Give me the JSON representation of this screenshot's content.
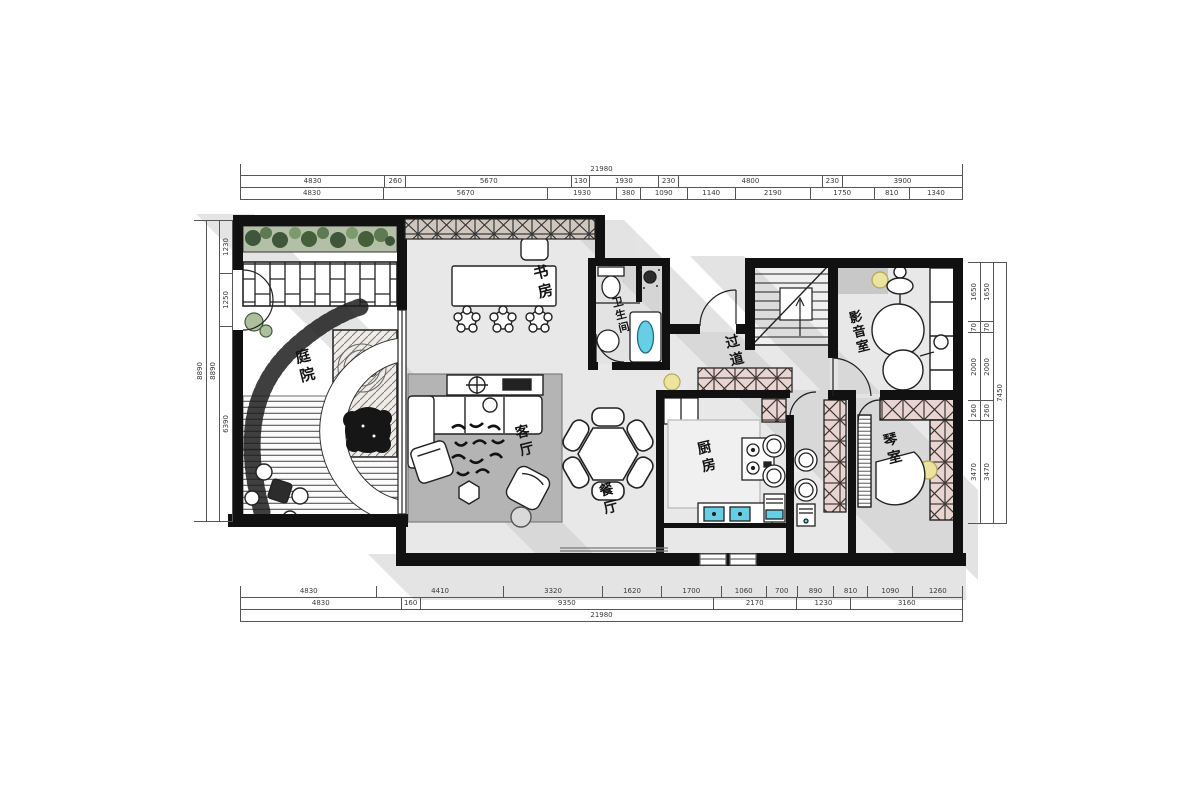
{
  "rooms": {
    "study": "书房",
    "bath": "卫生间",
    "corridor": "过道",
    "media": "影音室",
    "courtyard": "庭院",
    "living": "客厅",
    "dining": "餐厅",
    "kitchen": "厨房",
    "piano": "琴室"
  },
  "dims": {
    "top": {
      "total": "21980",
      "row1": [
        "4830",
        "260",
        "5670",
        "130",
        "1930",
        "230",
        "4800",
        "230",
        "3900"
      ],
      "row2": [
        "4830",
        "5670",
        "1930",
        "380",
        "1090",
        "1140",
        "2190",
        "1750",
        "810",
        "1340"
      ]
    },
    "bottom": {
      "row1": [
        "4830",
        "4410",
        "3320",
        "1620",
        "1700",
        "1060",
        "700",
        "890",
        "810",
        "1090",
        "1260"
      ],
      "row2": [
        "4830",
        "160",
        "9350",
        "2170",
        "1230",
        "3160"
      ],
      "total": "21980"
    },
    "left": {
      "totals": [
        "8890",
        "8890"
      ],
      "segments": [
        "1230",
        "1250",
        "6390"
      ]
    },
    "right": {
      "segments": [
        "1650",
        "70",
        "2000",
        "260",
        "3470"
      ],
      "total": "7450"
    }
  },
  "colors": {
    "wall": "#111111",
    "floor": "#e8e8e8",
    "rug": "#b4b4b4",
    "shadow": "#c9c9c9",
    "pink_hatch": "#e8d4d0",
    "plant_green": "#8ba37a",
    "plant_dark": "#3e5639",
    "lamp_yellow": "#ece49e",
    "water_blue": "#66cfe6"
  }
}
